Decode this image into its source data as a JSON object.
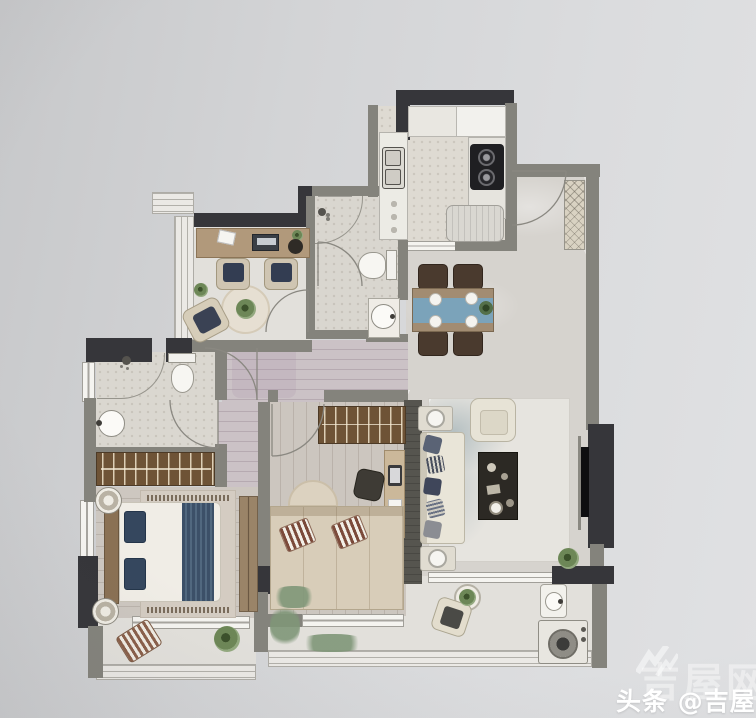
{
  "watermark": {
    "channel_label": "头条 @吉屋网",
    "site_name_faint": "吉屋网",
    "logo_icon": "jiwu-double-check-logo",
    "text_color": "#ffffff"
  },
  "palette": {
    "canvas": "#d4d5d7",
    "wall_dark": "#37373b",
    "wall_gray": "#84837c",
    "window_fill": "#f4f3ef",
    "wood_desk": "#b1997b",
    "wardrobe_wood": "#6e5336",
    "bed_runner_blue": "#3c5068",
    "dining_runner_blue": "#7ba3ba",
    "sofa_cream": "#e9e5d8",
    "coffee_table_dark": "#2c2924",
    "plant_green": "#6d8757",
    "marble_floor": "#d6d3ce",
    "wood_floor": "#cdc7c0",
    "tile_floor": "#dedad2"
  },
  "rooms": [
    {
      "name": "kitchen"
    },
    {
      "name": "guest-bathroom"
    },
    {
      "name": "study"
    },
    {
      "name": "entry-foyer"
    },
    {
      "name": "dining-area"
    },
    {
      "name": "hallway"
    },
    {
      "name": "master-bathroom"
    },
    {
      "name": "master-bedroom"
    },
    {
      "name": "second-bedroom"
    },
    {
      "name": "living-room"
    },
    {
      "name": "master-balcony"
    },
    {
      "name": "living-balcony"
    }
  ]
}
